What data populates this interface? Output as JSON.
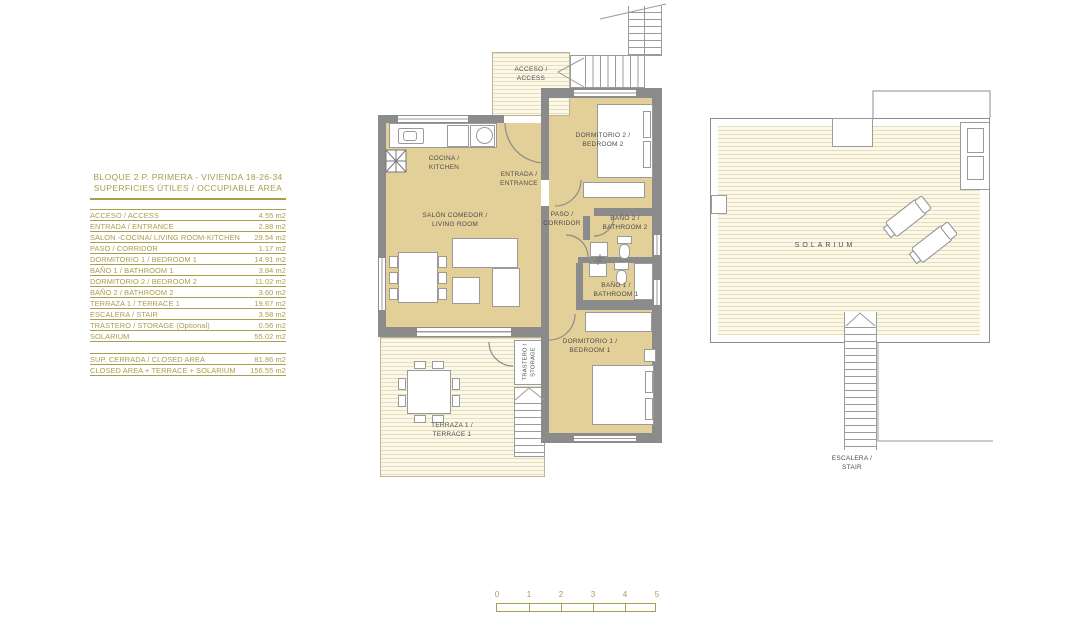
{
  "panel": {
    "title_line1": "BLOQUE 2  P. PRIMERA - VIVIENDA 18-26-34",
    "title_line2": "SUPERFICIES ÚTILES / OCCUPIABLE  AREA",
    "rows": [
      {
        "label": "ACCESO / ACCESS",
        "value": "4.55 m2"
      },
      {
        "label": "ENTRADA / ENTRANCE",
        "value": "2.88 m2"
      },
      {
        "label": "SALON -COCINA/ LIVING ROOM-KITCHEN",
        "value": "29.54 m2"
      },
      {
        "label": "PASO / CORRIDOR",
        "value": "1.17 m2"
      },
      {
        "label": "DORMITORIO 1 /  BEDROOM 1",
        "value": "14.91 m2"
      },
      {
        "label": "BAÑO 1 / BATHROOM 1",
        "value": "3.84 m2"
      },
      {
        "label": "DORMITORIO 2 / BEDROOM 2",
        "value": "11.02 m2"
      },
      {
        "label": "BAÑO 2 / BATHROOM 2",
        "value": "3.60 m2"
      },
      {
        "label": "TERRAZA 1 / TERRACE 1",
        "value": "19.67 m2"
      },
      {
        "label": "ESCALERA / STAIR",
        "value": "3.58 m2"
      },
      {
        "label": "TRASTERO / STORAGE (Optional)",
        "value": "0.56 m2"
      },
      {
        "label": "SOLARIUM",
        "value": "55.02 m2"
      }
    ],
    "summary": [
      {
        "label": "SUP. CERRADA / CLOSED AREA",
        "value": "81.86 m2"
      },
      {
        "label": "CLOSED AREA + TERRACE + SOLARIUM",
        "value": "156.55 m2"
      }
    ]
  },
  "plan": {
    "rooms": {
      "acceso": {
        "line1": "ACCESO /",
        "line2": "ACCESS"
      },
      "cocina": {
        "line1": "COCINA /",
        "line2": "KITCHEN"
      },
      "entrada": {
        "line1": "ENTRADA /",
        "line2": "ENTRANCE"
      },
      "salon": {
        "line1": "SALÓN COMEDOR /",
        "line2": "LIVING ROOM"
      },
      "paso": {
        "line1": "PASO /",
        "line2": "CORRIDOR"
      },
      "dormitorio2": {
        "line1": "DORMITORIO 2 /",
        "line2": "BEDROOM 2"
      },
      "bano2": {
        "line1": "BAÑO 2 /",
        "line2": "BATHROOM 2"
      },
      "bano1": {
        "line1": "BAÑO 1 /",
        "line2": "BATHROOM 1"
      },
      "dormitorio1": {
        "line1": "DORMITORIO 1 /",
        "line2": "BEDROOM 1"
      },
      "terraza": {
        "line1": "TERRAZA 1 /",
        "line2": "TERRACE 1"
      },
      "trastero": {
        "line1": "TRASTERO /",
        "line2": "STORAGE"
      },
      "solarium": {
        "line1": "SOLARIUM"
      },
      "escalera": {
        "line1": "ESCALERA /",
        "line2": "STAIR"
      }
    }
  },
  "scale": {
    "ticks": [
      "0",
      "1",
      "2",
      "3",
      "4",
      "5"
    ]
  },
  "colors": {
    "accent_olive": "#a79e4e",
    "room_fill": "#e3cf98",
    "wall_gray": "#8b8b8b",
    "stripe_line": "#e6deb6",
    "stripe_bg": "#fbf8ea",
    "label_gray": "#4d4d4d"
  }
}
